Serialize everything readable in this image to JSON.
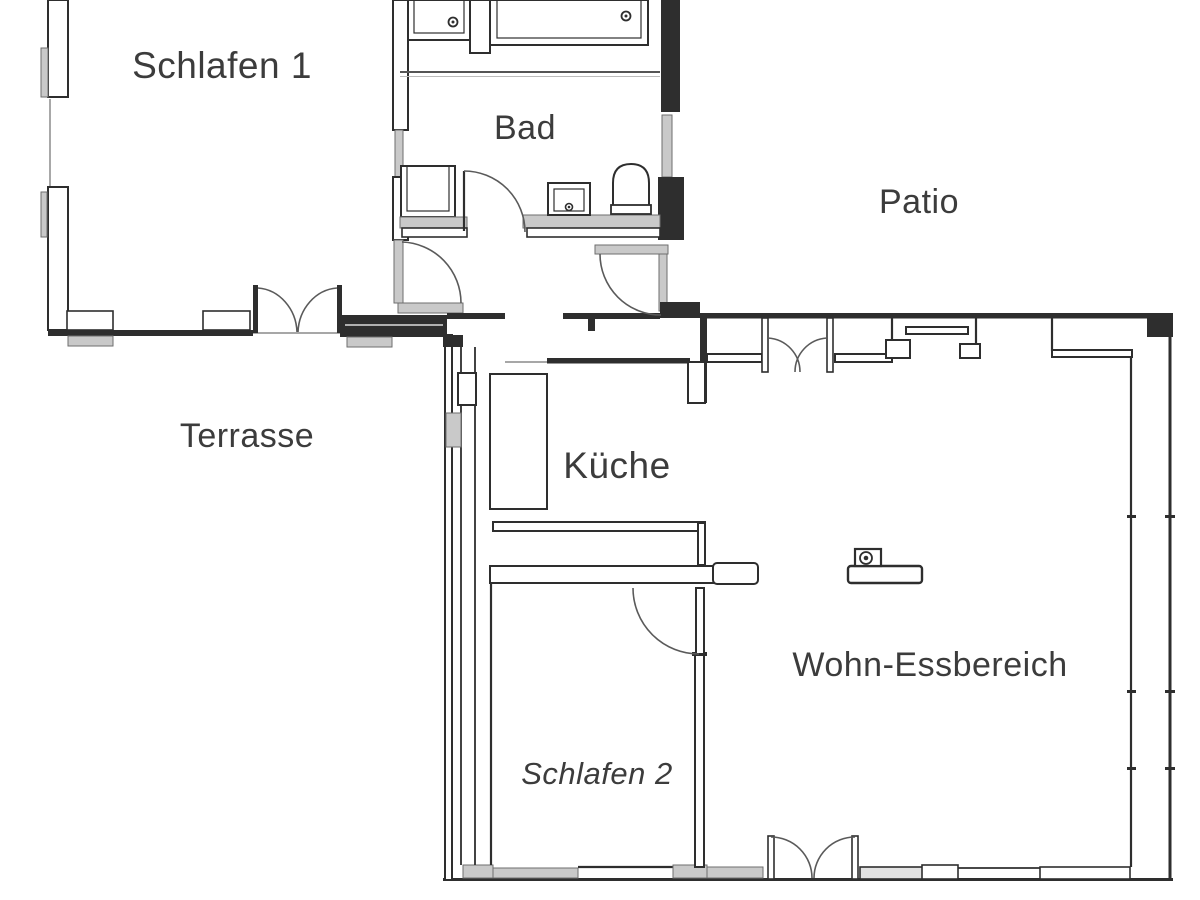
{
  "plan_title": "Apartment floor plan",
  "rooms": {
    "schlafen1": {
      "label": "Schlafen 1"
    },
    "bad": {
      "label": "Bad"
    },
    "patio": {
      "label": "Patio"
    },
    "terrasse": {
      "label": "Terrasse"
    },
    "kueche": {
      "label": "Küche"
    },
    "wohn": {
      "label": "Wohn-Essbereich"
    },
    "schlafen2": {
      "label": "Schlafen 2"
    }
  },
  "colors": {
    "wall": "#2e2e2e",
    "label": "#3c3c3c",
    "sill": "#c9c9c9",
    "background": "#ffffff"
  }
}
